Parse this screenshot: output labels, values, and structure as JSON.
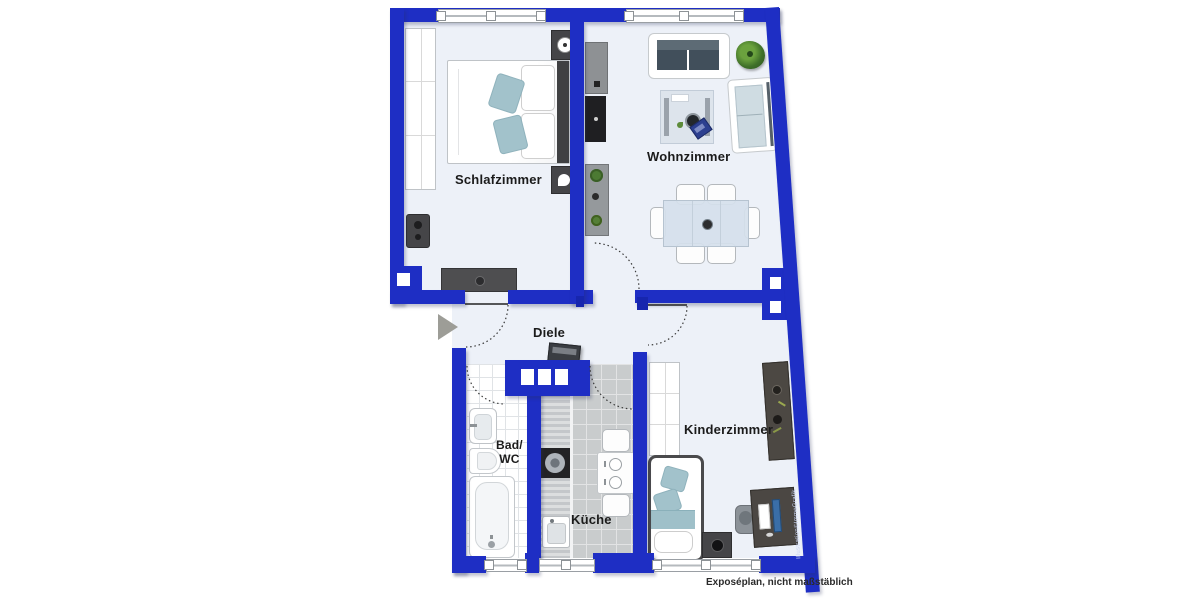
{
  "meta": {
    "type": "apartment-floor-plan",
    "style": "2D top-down Exposé plan",
    "colors": {
      "wall_blue": "#1e2ec4",
      "wall_blue_dark": "#1322a0",
      "floor_light": "#edf1f8",
      "bath_floor": "#ffffff",
      "kitchen_floor": "#c9cccd",
      "label_text": "#1b1b1b",
      "entrance_arrow": "#9d9d97",
      "accent_teal": "#a2c2cb",
      "plant_green": "#4c7a33"
    }
  },
  "rooms": [
    {
      "id": "schlafzimmer",
      "label": "Schlafzimmer"
    },
    {
      "id": "wohnzimmer",
      "label": "Wohnzimmer"
    },
    {
      "id": "diele",
      "label": "Diele"
    },
    {
      "id": "bad_wc",
      "label_line1": "Bad/",
      "label_line2": "WC"
    },
    {
      "id": "kueche",
      "label": "Küche"
    },
    {
      "id": "kinderzimmer",
      "label": "Kinderzimmer"
    }
  ],
  "annotations": {
    "disclaimer": "Exposéplan, nicht maßstäblich",
    "watermark": "Illustration©ImmoGrafik"
  },
  "icons": [
    "entrance-arrow-icon",
    "double-bed-icon",
    "wardrobe-icon",
    "nightstand-icon",
    "dresser-icon",
    "speaker-icon",
    "tv-icon",
    "media-board-icon",
    "plant-shelf-icon",
    "sofa-icon",
    "couch-icon",
    "corner-plant-icon",
    "rug-table-icon",
    "laptop-icon",
    "dining-table-icon",
    "chair-icon",
    "console-icon",
    "bath-sink-icon",
    "toilet-icon",
    "bathtub-icon",
    "kitchen-counter-icon",
    "stove-icon",
    "kitchen-sink-icon",
    "kitchen-table-icon",
    "child-bed-icon",
    "desk-icon",
    "office-chair-icon",
    "shelf-icon",
    "window-icon",
    "door-swing-arc",
    "chimney-icon"
  ]
}
